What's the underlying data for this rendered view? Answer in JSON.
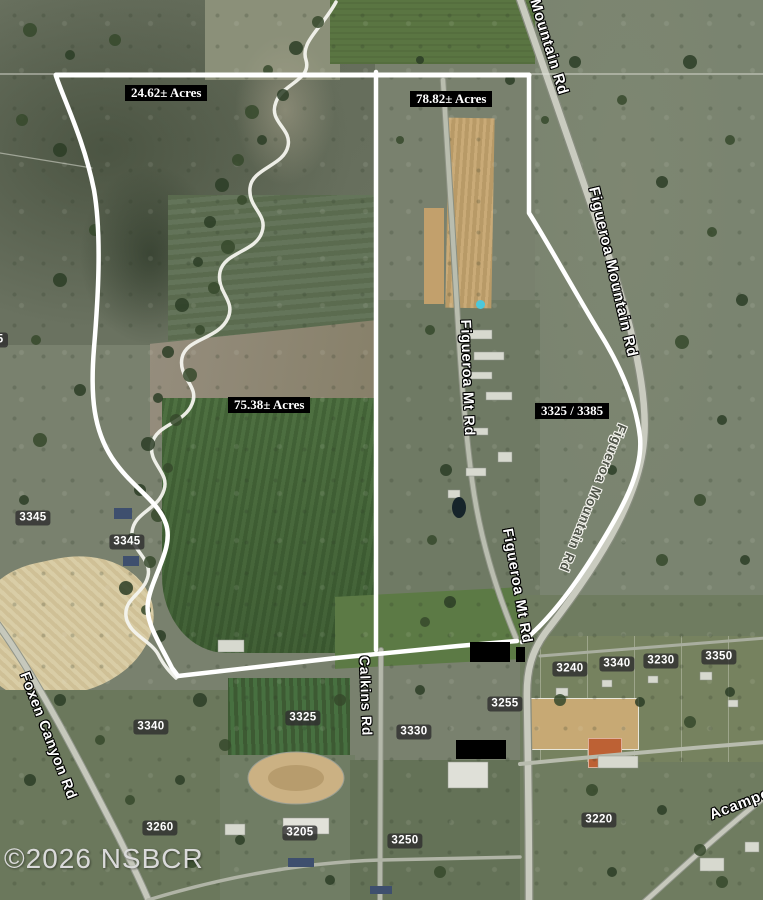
{
  "map": {
    "watermark": "©2026 NSBCR",
    "acreage_labels": [
      "24.62± Acres",
      "78.82± Acres",
      "75.38± Acres"
    ],
    "parcel_pair_label": "3325 / 3385",
    "road_labels": {
      "mountain_rd": "Mountain Rd",
      "figueroa_mountain_rd_upper": "Figueroa Mountain Rd",
      "figueroa_mt_rd_upper": "Figueroa Mt Rd",
      "figueroa_mt_rd_lower": "Figueroa Mt Rd",
      "figueroa_mountain_rd_lower": "Figueroa Mountain Rd",
      "calkins_rd": "Calkins Rd",
      "foxen_canyon_rd": "Foxen Canyon Rd",
      "acampo": "Acampo"
    },
    "parcel_numbers": [
      "35",
      "3345",
      "3345",
      "3340",
      "3325",
      "3330",
      "3255",
      "3240",
      "3340",
      "3230",
      "3350",
      "3260",
      "3205",
      "3250",
      "3220"
    ],
    "colors": {
      "boundary_line": "#ffffff",
      "acreage_label_bg": "#000000",
      "acreage_label_text": "#ffffff",
      "parcel_chip_bg": "#2f2f2f",
      "parcel_chip_text": "#ffffff",
      "road_label_text": "#ffffff",
      "pool": "#4cc8dc",
      "watermark_text": "#d9d9d9",
      "redaction": "#000000"
    }
  }
}
